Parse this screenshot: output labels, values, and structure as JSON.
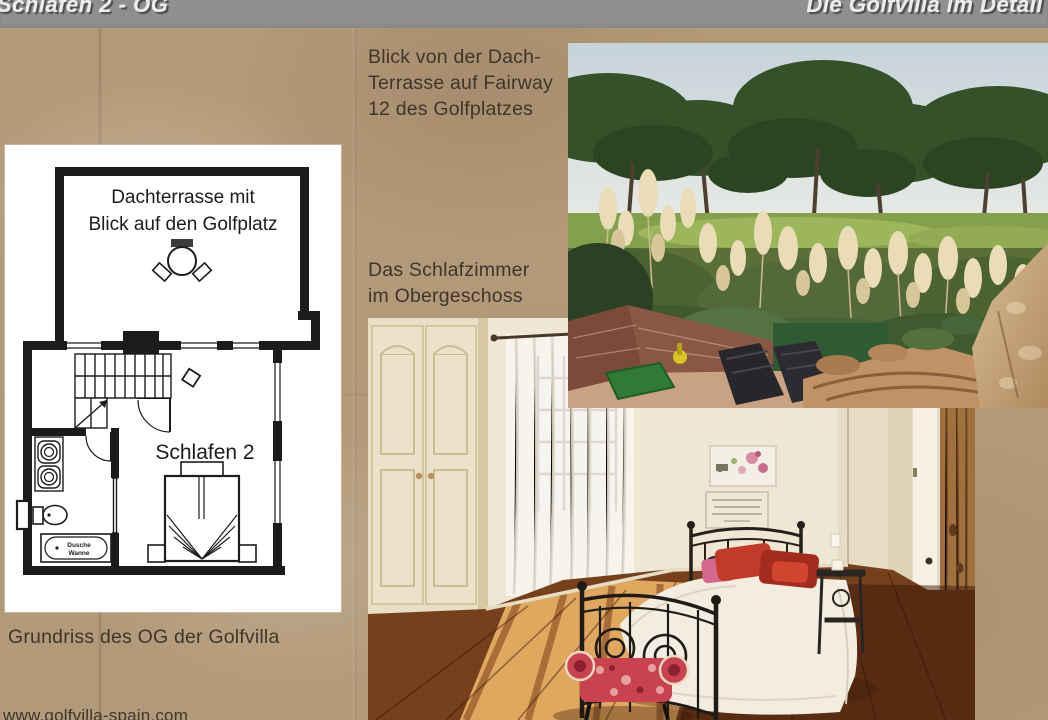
{
  "header": {
    "left_title": "Schlafen 2 - OG",
    "right_title": "Die Golfvilla im Detail"
  },
  "captions": {
    "golf": {
      "lines": [
        "Blick von der Dach-",
        "Terrasse auf Fairway",
        "12 des Golfplatzes"
      ]
    },
    "bedroom": {
      "lines": [
        "Das Schlafzimmer",
        "im Obergeschoss"
      ]
    },
    "floorplan": "Grundriss des OG der Golfvilla",
    "website": "www.golfvilla-spain.com"
  },
  "floorplan": {
    "terrace_line1": "Dachterrasse mit",
    "terrace_line2": "Blick auf den Golfplatz",
    "bedroom_label": "Schlafen 2",
    "shower_line1": "Dusche",
    "shower_line2": "Wanne"
  },
  "photos": {
    "golf_photo_name": "view-from-roof-terrace-to-golf-course",
    "bedroom_photo_name": "upper-floor-bedroom"
  },
  "colors": {
    "page_background": "#b29979",
    "header_bar": "#8f8f8f",
    "header_text": "#ededed",
    "caption_text": "#3e362c",
    "plan_paper": "#ffffff",
    "plan_ink": "#1c1c1c",
    "floor_wood_dark": "#6e3a1e",
    "floor_wood_sunlit": "#dfa35f",
    "pillow_red": "#c23a28",
    "terrace_stone": "#c7a47c"
  }
}
